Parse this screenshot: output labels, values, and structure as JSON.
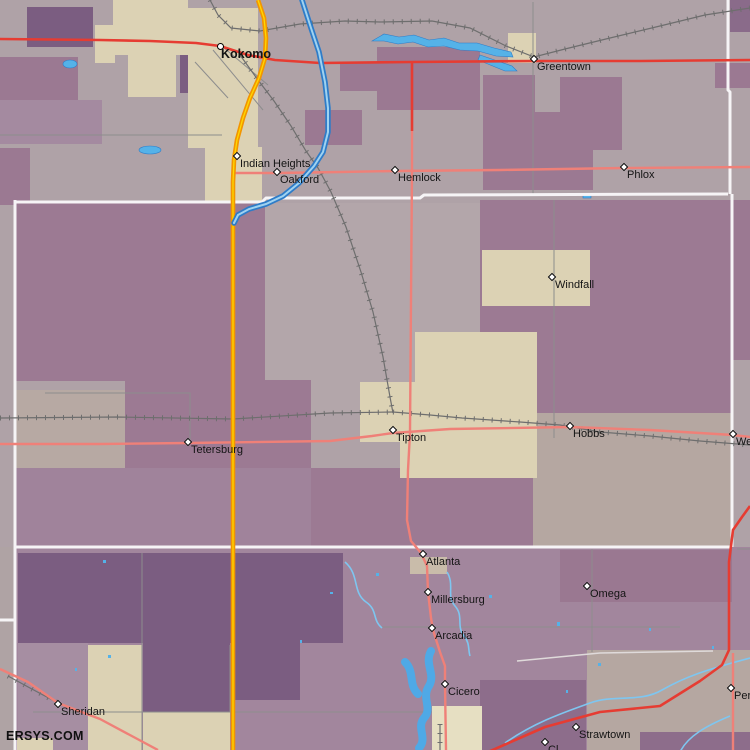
{
  "map": {
    "watermark": "ERSYS.COM",
    "towns": [
      {
        "name": "Kokomo",
        "x": 220,
        "y": 46,
        "bold": true
      },
      {
        "name": "Indian Heights",
        "x": 237,
        "y": 156,
        "bold": false
      },
      {
        "name": "Oakford",
        "x": 277,
        "y": 172,
        "bold": false
      },
      {
        "name": "Hemlock",
        "x": 395,
        "y": 170,
        "bold": false
      },
      {
        "name": "Greentown",
        "x": 534,
        "y": 59,
        "bold": false
      },
      {
        "name": "Phlox",
        "x": 624,
        "y": 167,
        "bold": false
      },
      {
        "name": "Windfall",
        "x": 552,
        "y": 277,
        "bold": false
      },
      {
        "name": "Tetersburg",
        "x": 188,
        "y": 442,
        "bold": false
      },
      {
        "name": "Tipton",
        "x": 393,
        "y": 430,
        "bold": false
      },
      {
        "name": "Hobbs",
        "x": 570,
        "y": 426,
        "bold": false
      },
      {
        "name": "We",
        "x": 733,
        "y": 434,
        "bold": false
      },
      {
        "name": "Atlanta",
        "x": 423,
        "y": 554,
        "bold": false
      },
      {
        "name": "Millersburg",
        "x": 428,
        "y": 592,
        "bold": false
      },
      {
        "name": "Omega",
        "x": 587,
        "y": 586,
        "bold": false
      },
      {
        "name": "Arcadia",
        "x": 432,
        "y": 628,
        "bold": false
      },
      {
        "name": "Sheridan",
        "x": 58,
        "y": 704,
        "bold": false
      },
      {
        "name": "Cicero",
        "x": 445,
        "y": 684,
        "bold": false
      },
      {
        "name": "Strawtown",
        "x": 576,
        "y": 727,
        "bold": false
      },
      {
        "name": "Cl",
        "x": 545,
        "y": 742,
        "bold": false
      },
      {
        "name": "Per",
        "x": 731,
        "y": 688,
        "bold": false
      }
    ],
    "colors": {
      "county_boundary_white": "#f6f4f6",
      "highway_orange": "#f29500",
      "highway_yellow_center": "#ffd800",
      "primary_road_red": "#e63c32",
      "secondary_road_pink": "#ef8078",
      "railroad_gray": "#6e6e6e",
      "water_blue": "#55b2e8",
      "river_outline_blue": "#2e7cc8",
      "shade_dark_purple": "#7b5d81",
      "shade_medium_purple": "#9c7a93",
      "shade_mauve": "#a2869d",
      "shade_light_gray_purple": "#b3a6aa",
      "shade_cream": "#dcd2b4"
    }
  }
}
